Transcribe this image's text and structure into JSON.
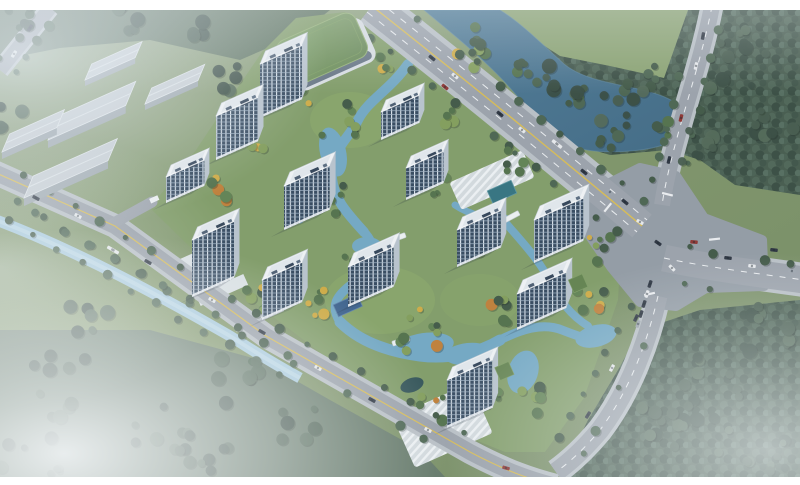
{
  "image_alt": "Aerial rendering of a riverside residential development: thirteen white high-rise towers with dark glass facades around winding blue waterways and autumn landscaping, a green-roofed podium building at the north edge, gray warehouses to the north-west, a canal and perimeter road on the west, a major road intersection with traffic on the east, and dense forest with fog around the site",
  "palette": {
    "frame": "#ffffff",
    "grass": "#7d9464",
    "grass_hazy": "#9aab8c",
    "field": "#87a06c",
    "forest": "#415748",
    "forest_light": "#4e6552",
    "forest_haze": "#5d7264",
    "river": "#47738f",
    "river_deep": "#3c6681",
    "canal": "#a6cadd",
    "pond": "#6fa6c2",
    "pond_light": "#a8cfdf",
    "road": "#99a0a8",
    "road_dark": "#9199a2",
    "sidewalk": "#b8bfc4",
    "line_yellow": "#d9bb4e",
    "line_white": "#eceef0",
    "facade_glass": "#30445a",
    "facade_mullion": "#dfe7ee",
    "roof_white": "#f1f4f6",
    "roof_deck": "#e2e8ec",
    "side_face": "#b7c2cc",
    "green_roof": "#70905a",
    "warehouse_roof": "#c6cdd2",
    "warehouse_side": "#9ba5ac",
    "plaza": "#dde3e6",
    "court_blue": "#3a5f8a",
    "pool": "#2f6f7c",
    "pavilion": "#2e4f52",
    "tree_green": "#4e6d45",
    "tree_dark": "#3c5340",
    "tree_light": "#7f9b55",
    "tree_yellow": "#cfa93f",
    "tree_orange": "#bf7c33",
    "car_dark": "#262e3a",
    "car_white": "#e8eaec",
    "car_red": "#8b2f2a",
    "car_gray": "#9aa2ab",
    "fog": "#f4f7f9"
  },
  "counts": {
    "towers": 13,
    "warehouses": 5,
    "footbridges": 3
  },
  "podium": {
    "id": "green-roof-podium",
    "cx": 322,
    "cy": 49,
    "w": 86,
    "d": 48,
    "rot": -24
  },
  "towers": [
    {
      "id": "tower-1",
      "x": 260,
      "y": 64,
      "w": 46,
      "d": 13,
      "h": 54,
      "annex": false
    },
    {
      "id": "tower-2",
      "x": 216,
      "y": 116,
      "w": 46,
      "d": 13,
      "h": 44,
      "annex": false
    },
    {
      "id": "tower-3",
      "x": 166,
      "y": 177,
      "w": 42,
      "d": 12,
      "h": 26,
      "annex": false
    },
    {
      "id": "tower-4",
      "x": 192,
      "y": 240,
      "w": 46,
      "d": 13,
      "h": 57,
      "annex": false
    },
    {
      "id": "tower-5",
      "x": 262,
      "y": 280,
      "w": 44,
      "d": 13,
      "h": 40,
      "annex": false
    },
    {
      "id": "tower-6",
      "x": 284,
      "y": 186,
      "w": 50,
      "d": 14,
      "h": 44,
      "annex": false
    },
    {
      "id": "tower-7",
      "x": 348,
      "y": 267,
      "w": 50,
      "d": 14,
      "h": 40,
      "annex": false
    },
    {
      "id": "tower-8",
      "x": 381,
      "y": 112,
      "w": 42,
      "d": 12,
      "h": 28,
      "annex": false
    },
    {
      "id": "tower-9",
      "x": 406,
      "y": 168,
      "w": 41,
      "d": 12,
      "h": 32,
      "annex": false
    },
    {
      "id": "tower-10",
      "x": 457,
      "y": 230,
      "w": 48,
      "d": 13,
      "h": 37,
      "annex": false
    },
    {
      "id": "tower-11",
      "x": 534,
      "y": 220,
      "w": 54,
      "d": 14,
      "h": 43,
      "annex": false
    },
    {
      "id": "tower-12",
      "x": 517,
      "y": 294,
      "w": 54,
      "d": 14,
      "h": 36,
      "annex": true
    },
    {
      "id": "tower-13",
      "x": 447,
      "y": 380,
      "w": 50,
      "d": 13,
      "h": 48,
      "annex": true
    }
  ],
  "warehouses": [
    {
      "id": "warehouse-1",
      "x": 85,
      "y": 80,
      "w": 55,
      "d": 16,
      "h": 6
    },
    {
      "id": "warehouse-2",
      "x": 145,
      "y": 104,
      "w": 58,
      "d": 16,
      "h": 6
    },
    {
      "id": "warehouse-3",
      "x": 48,
      "y": 140,
      "w": 85,
      "d": 24,
      "h": 8
    },
    {
      "id": "warehouse-4",
      "x": 2,
      "y": 152,
      "w": 60,
      "d": 18,
      "h": 7
    },
    {
      "id": "warehouse-5",
      "x": 24,
      "y": 198,
      "w": 92,
      "d": 22,
      "h": 8
    }
  ],
  "sports_court": {
    "cx": 348,
    "cy": 306,
    "w": 26,
    "h": 13,
    "rot": -24
  },
  "pool": {
    "cx": 502,
    "cy": 192,
    "w": 26,
    "h": 14,
    "rot": -24
  },
  "footbridges": [
    {
      "cx": 397,
      "cy": 238,
      "rot": -20
    },
    {
      "cx": 511,
      "cy": 217,
      "rot": -28
    },
    {
      "cx": 401,
      "cy": 341,
      "rot": -18
    }
  ],
  "cars": [
    {
      "x": 432,
      "y": 58,
      "rot": 39,
      "c": "car_dark"
    },
    {
      "x": 455,
      "y": 76,
      "rot": 39,
      "c": "car_white"
    },
    {
      "x": 445,
      "y": 87,
      "rot": 39,
      "c": "car_red"
    },
    {
      "x": 500,
      "y": 114,
      "rot": 39,
      "c": "car_dark"
    },
    {
      "x": 522,
      "y": 130,
      "rot": 39,
      "c": "car_white"
    },
    {
      "x": 557,
      "y": 144,
      "rot": 39,
      "c": "car_white",
      "len": 12
    },
    {
      "x": 584,
      "y": 172,
      "rot": 39,
      "c": "car_dark"
    },
    {
      "x": 610,
      "y": 192,
      "rot": 39,
      "c": "car_gray"
    },
    {
      "x": 703,
      "y": 36,
      "rot": 100,
      "c": "car_dark"
    },
    {
      "x": 696,
      "y": 66,
      "rot": 102,
      "c": "car_white"
    },
    {
      "x": 681,
      "y": 118,
      "rot": 104,
      "c": "car_red"
    },
    {
      "x": 669,
      "y": 160,
      "rot": 104,
      "c": "car_dark"
    },
    {
      "x": 728,
      "y": 258,
      "rot": 6,
      "c": "car_dark"
    },
    {
      "x": 752,
      "y": 266,
      "rot": 6,
      "c": "car_white"
    },
    {
      "x": 774,
      "y": 250,
      "rot": 6,
      "c": "car_dark"
    },
    {
      "x": 792,
      "y": 271,
      "rot": 6,
      "c": "car_gray"
    },
    {
      "x": 640,
      "y": 222,
      "rot": 30,
      "c": "car_white"
    },
    {
      "x": 658,
      "y": 243,
      "rot": 35,
      "c": "car_dark"
    },
    {
      "x": 694,
      "y": 242,
      "rot": 5,
      "c": "car_red"
    },
    {
      "x": 672,
      "y": 268,
      "rot": 45,
      "c": "car_white"
    },
    {
      "x": 625,
      "y": 202,
      "rot": 39,
      "c": "car_dark"
    },
    {
      "x": 650,
      "y": 284,
      "rot": 108,
      "c": "car_dark"
    },
    {
      "x": 647,
      "y": 294,
      "rot": 108,
      "c": "car_white"
    },
    {
      "x": 644,
      "y": 304,
      "rot": 108,
      "c": "car_dark"
    },
    {
      "x": 641,
      "y": 314,
      "rot": 108,
      "c": "car_dark"
    },
    {
      "x": 638,
      "y": 324,
      "rot": 108,
      "c": "car_gray"
    },
    {
      "x": 636,
      "y": 318,
      "rot": 115,
      "c": "car_dark"
    },
    {
      "x": 612,
      "y": 368,
      "rot": 118,
      "c": "car_white"
    },
    {
      "x": 588,
      "y": 415,
      "rot": 122,
      "c": "car_dark"
    },
    {
      "x": 36,
      "y": 198,
      "rot": 28,
      "c": "car_dark"
    },
    {
      "x": 78,
      "y": 216,
      "rot": 28,
      "c": "car_white"
    },
    {
      "x": 113,
      "y": 250,
      "rot": 30,
      "c": "car_white",
      "len": 13
    },
    {
      "x": 148,
      "y": 262,
      "rot": 30,
      "c": "car_dark"
    },
    {
      "x": 212,
      "y": 300,
      "rot": 30,
      "c": "car_white"
    },
    {
      "x": 262,
      "y": 332,
      "rot": 30,
      "c": "car_dark"
    },
    {
      "x": 318,
      "y": 368,
      "rot": 30,
      "c": "car_white"
    },
    {
      "x": 372,
      "y": 400,
      "rot": 29,
      "c": "car_dark"
    },
    {
      "x": 428,
      "y": 430,
      "rot": 28,
      "c": "car_white"
    },
    {
      "x": 506,
      "y": 468,
      "rot": 16,
      "c": "car_red"
    },
    {
      "x": 30,
      "y": 28,
      "rot": 122,
      "c": "car_dark"
    },
    {
      "x": 14,
      "y": 54,
      "rot": 122,
      "c": "car_white"
    }
  ]
}
